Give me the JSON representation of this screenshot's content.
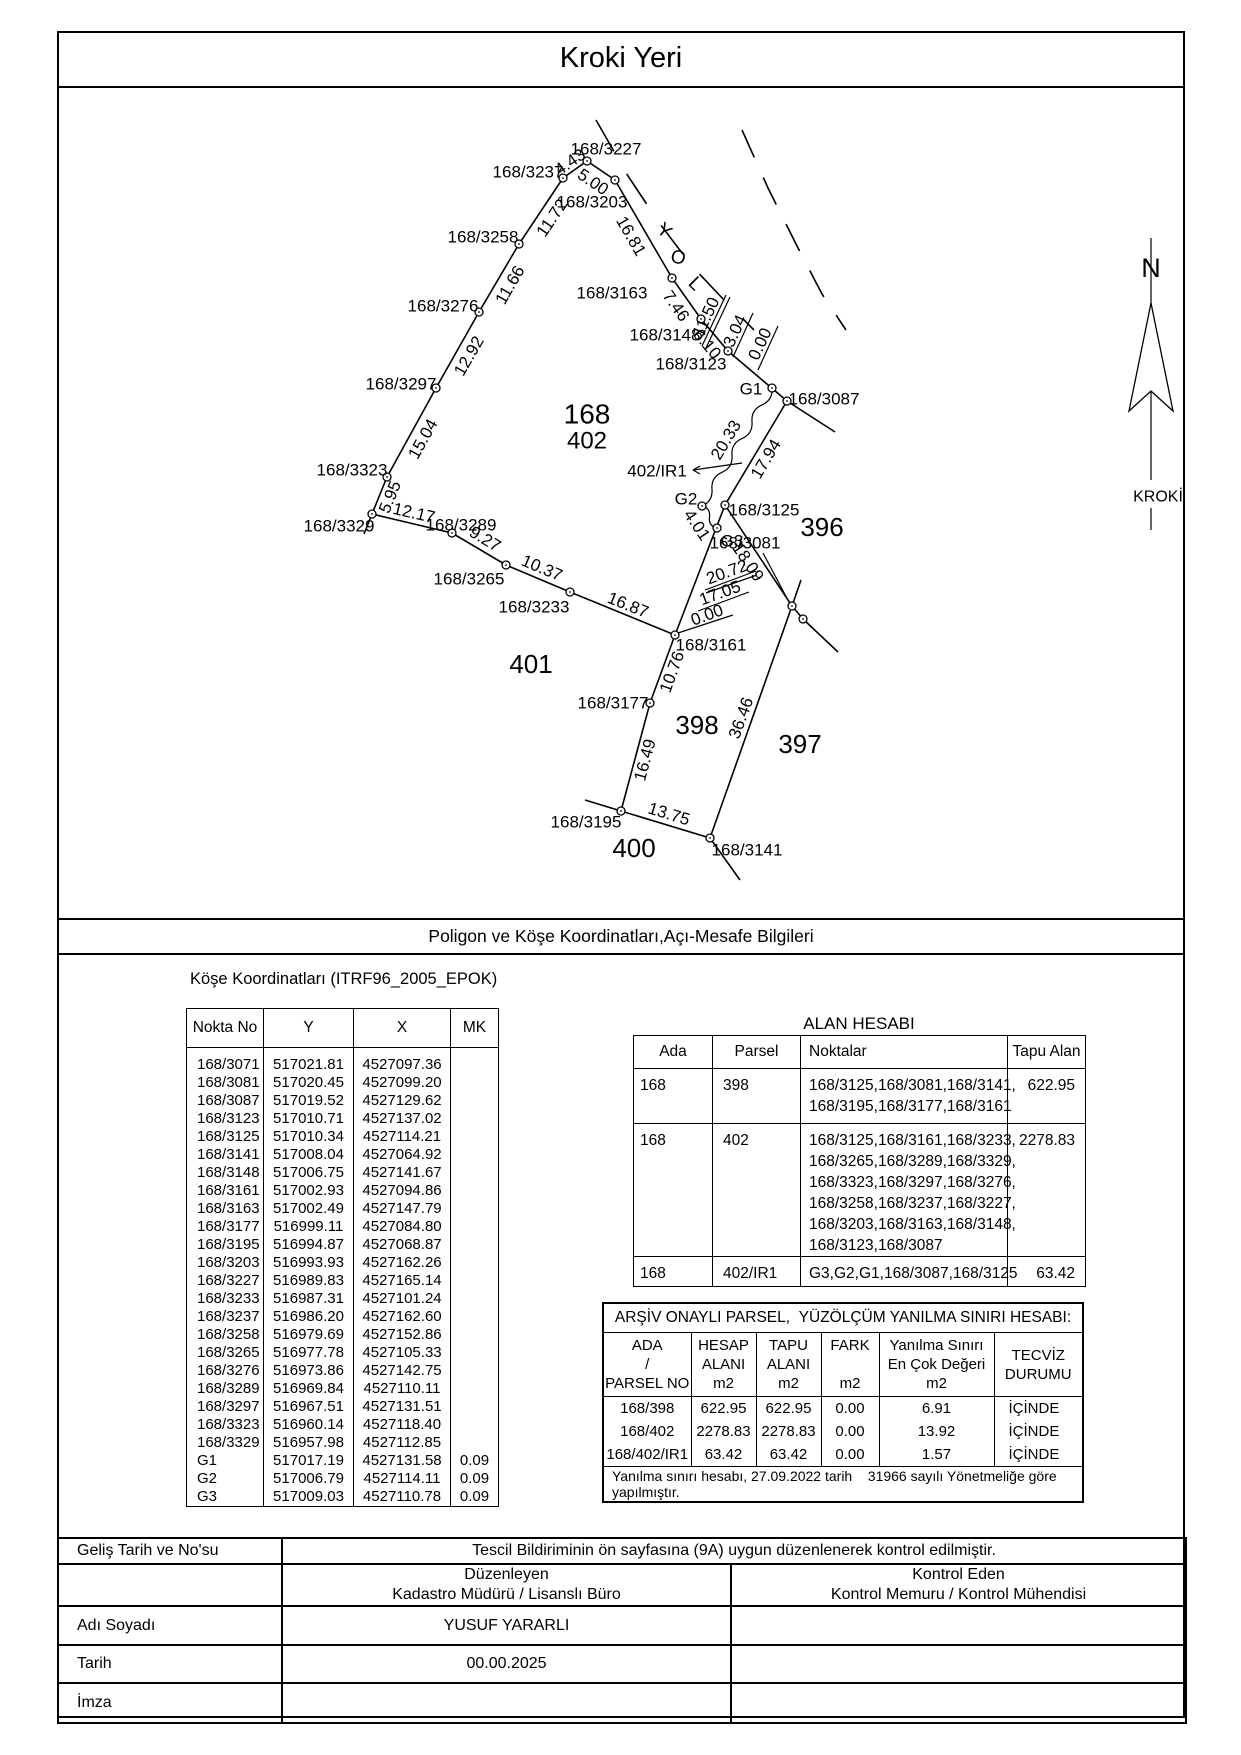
{
  "page": {
    "title": "Kroki Yeri",
    "section_bar": "Poligon ve Köşe Koordinatları,Açı-Mesafe Bilgileri"
  },
  "map": {
    "north": {
      "n": "N",
      "kroki": "KROKİ"
    },
    "yol": {
      "letters": [
        {
          "t": "Y",
          "x": 664,
          "y": 231,
          "r": 40
        },
        {
          "t": "O",
          "x": 678,
          "y": 258,
          "r": 15
        },
        {
          "t": "L",
          "x": 695,
          "y": 284,
          "r": 45
        }
      ]
    },
    "points": {
      "3227": [
        587,
        161
      ],
      "3237": [
        563,
        178
      ],
      "3203": [
        615,
        180
      ],
      "3258": [
        519,
        244
      ],
      "3163": [
        672,
        278
      ],
      "3276": [
        479,
        312
      ],
      "3148": [
        701,
        319
      ],
      "3123": [
        728,
        351
      ],
      "3297": [
        436,
        388
      ],
      "G1": [
        772,
        388
      ],
      "3087": [
        787,
        401
      ],
      "3323": [
        387,
        477
      ],
      "3125": [
        725,
        505
      ],
      "G2": [
        702,
        506
      ],
      "3329": [
        372,
        514
      ],
      "G3": [
        717,
        528
      ],
      "3289": [
        452,
        533
      ],
      "3265": [
        506,
        565
      ],
      "3233": [
        570,
        592
      ],
      "3081": [
        792,
        606
      ],
      "3071": [
        803,
        619
      ],
      "3161": [
        675,
        635
      ],
      "3177": [
        650,
        703
      ],
      "3195": [
        621,
        811
      ],
      "3141": [
        710,
        838
      ]
    },
    "chains": [
      [
        "3329",
        "3323",
        "3297",
        "3276",
        "3258",
        "3237",
        "3227",
        "3203",
        "3163",
        "3148",
        "3123",
        "3087"
      ],
      [
        "3087",
        "3125",
        "3161"
      ],
      [
        "3161",
        "3233",
        "3265",
        "3289",
        "3329"
      ],
      [
        "3161",
        "3177",
        "3195",
        "3141",
        "3081",
        "3125"
      ],
      [
        "3081",
        "3071"
      ]
    ],
    "extensions": [
      [
        372,
        514,
        364,
        534
      ],
      [
        621,
        811,
        585,
        800
      ],
      [
        710,
        838,
        740,
        880
      ],
      [
        787,
        401,
        835,
        432
      ],
      [
        792,
        606,
        801,
        580
      ],
      [
        803,
        619,
        838,
        652
      ]
    ],
    "squiggle": "M772,388 Q773,400 762,404.9 Q751,409.7 752,421.7 Q753,433.7 742,438.6 Q731,443.4 732,455.4 Q733,467.4 722,472.3 Q711,477.1 712,489.1 Q713,501.1 702,506 Q710.7,508.1 709.5,517 Q708.3,525.9 717,528",
    "road_dashes": [
      {
        "pts": "596,120 628,176 660,224 692,266 724,300 754,330",
        "dash": "36 26"
      },
      {
        "pts": "742,130 768,188 796,244 822,294 846,330",
        "dash": "30 22"
      }
    ],
    "callout_lines": [
      [
        702,
        346,
        726,
        295
      ],
      [
        706,
        348,
        730,
        297
      ],
      [
        733,
        357,
        753,
        313
      ],
      [
        758,
        370,
        778,
        326
      ],
      [
        705,
        590,
        756,
        571
      ],
      [
        706,
        593,
        757,
        575
      ],
      [
        698,
        611,
        749,
        592
      ],
      [
        678,
        633,
        733,
        615
      ]
    ],
    "leaders": [
      [
        763,
        553,
        789,
        602
      ],
      [
        693,
        470,
        742,
        463
      ],
      [
        700,
        466,
        693,
        470
      ],
      [
        700,
        474,
        693,
        470
      ]
    ],
    "point_labels": [
      {
        "t": "168/3227",
        "x": 606,
        "y": 149
      },
      {
        "t": "168/3237",
        "x": 528,
        "y": 172
      },
      {
        "t": "168/3203",
        "x": 592,
        "y": 202
      },
      {
        "t": "168/3258",
        "x": 483,
        "y": 237
      },
      {
        "t": "168/3163",
        "x": 612,
        "y": 293
      },
      {
        "t": "168/3276",
        "x": 443,
        "y": 306
      },
      {
        "t": "168/3148",
        "x": 665,
        "y": 335
      },
      {
        "t": "168/3123",
        "x": 691,
        "y": 364
      },
      {
        "t": "168/3297",
        "x": 401,
        "y": 384
      },
      {
        "t": "G1",
        "x": 751,
        "y": 389
      },
      {
        "t": "168/3087",
        "x": 824,
        "y": 399
      },
      {
        "t": "168/3323",
        "x": 352,
        "y": 470
      },
      {
        "t": "402/IR1",
        "x": 657,
        "y": 471
      },
      {
        "t": "G2",
        "x": 686,
        "y": 499
      },
      {
        "t": "168/3125",
        "x": 764,
        "y": 510
      },
      {
        "t": "168/3329",
        "x": 339,
        "y": 526
      },
      {
        "t": "168/3289",
        "x": 461,
        "y": 525
      },
      {
        "t": "G3",
        "x": 732,
        "y": 541
      },
      {
        "t": "168/3081",
        "x": 745,
        "y": 543
      },
      {
        "t": "168/3265",
        "x": 469,
        "y": 579
      },
      {
        "t": "168/3233",
        "x": 534,
        "y": 607
      },
      {
        "t": "168/3161",
        "x": 711,
        "y": 645
      },
      {
        "t": "168/3177",
        "x": 613,
        "y": 703
      },
      {
        "t": "168/3195",
        "x": 586,
        "y": 822
      },
      {
        "t": "168/3141",
        "x": 747,
        "y": 850
      }
    ],
    "dist_labels": [
      {
        "t": "4.43",
        "x": 570,
        "y": 162,
        "r": -35
      },
      {
        "t": "5.00",
        "x": 593,
        "y": 182,
        "r": 34
      },
      {
        "t": "11.72",
        "x": 552,
        "y": 218,
        "r": -56
      },
      {
        "t": "16.81",
        "x": 631,
        "y": 236,
        "r": 60
      },
      {
        "t": "11.66",
        "x": 510,
        "y": 285,
        "r": -60
      },
      {
        "t": "7.46",
        "x": 676,
        "y": 306,
        "r": 55
      },
      {
        "t": "6.10",
        "x": 707,
        "y": 344,
        "r": 50
      },
      {
        "t": "11.50",
        "x": 706,
        "y": 317,
        "r": -65
      },
      {
        "t": "3.04",
        "x": 735,
        "y": 331,
        "r": -65
      },
      {
        "t": "0.00",
        "x": 760,
        "y": 344,
        "r": -65
      },
      {
        "t": "12.92",
        "x": 469,
        "y": 356,
        "r": -60
      },
      {
        "t": "20.33",
        "x": 726,
        "y": 440,
        "r": -59
      },
      {
        "t": "15.04",
        "x": 423,
        "y": 439,
        "r": -61
      },
      {
        "t": "17.94",
        "x": 766,
        "y": 459,
        "r": -59
      },
      {
        "t": "5.95",
        "x": 390,
        "y": 497,
        "r": -68
      },
      {
        "t": "12.17",
        "x": 414,
        "y": 513,
        "r": 13
      },
      {
        "t": "4.01",
        "x": 697,
        "y": 525,
        "r": 56
      },
      {
        "t": "9.27",
        "x": 485,
        "y": 539,
        "r": 31
      },
      {
        "t": "18.09",
        "x": 748,
        "y": 562,
        "r": 56
      },
      {
        "t": "10.37",
        "x": 542,
        "y": 568,
        "r": 23
      },
      {
        "t": "20.72",
        "x": 727,
        "y": 572,
        "r": -20
      },
      {
        "t": "17.05",
        "x": 720,
        "y": 593,
        "r": -20
      },
      {
        "t": "0.00",
        "x": 707,
        "y": 615,
        "r": -20
      },
      {
        "t": "16.87",
        "x": 628,
        "y": 605,
        "r": 22
      },
      {
        "t": "10.76",
        "x": 672,
        "y": 672,
        "r": -70
      },
      {
        "t": "36.46",
        "x": 741,
        "y": 718,
        "r": -70
      },
      {
        "t": "16.49",
        "x": 645,
        "y": 760,
        "r": -75
      },
      {
        "t": "13.75",
        "x": 669,
        "y": 814,
        "r": 17
      }
    ],
    "parcel_labels": [
      {
        "t": "168",
        "x": 587,
        "y": 414,
        "s": 28
      },
      {
        "t": "402",
        "x": 587,
        "y": 441,
        "s": 24
      },
      {
        "t": "396",
        "x": 822,
        "y": 527,
        "s": 26
      },
      {
        "t": "401",
        "x": 531,
        "y": 664,
        "s": 26
      },
      {
        "t": "398",
        "x": 697,
        "y": 725,
        "s": 26
      },
      {
        "t": "397",
        "x": 800,
        "y": 744,
        "s": 26
      },
      {
        "t": "400",
        "x": 634,
        "y": 848,
        "s": 26
      }
    ]
  },
  "coord_table": {
    "caption": "Köşe Koordinatları (ITRF96_2005_EPOK)",
    "headers": [
      "Nokta No",
      "Y",
      "X",
      "MK"
    ],
    "rows": [
      [
        "168/3071",
        "517021.81",
        "4527097.36",
        ""
      ],
      [
        "168/3081",
        "517020.45",
        "4527099.20",
        ""
      ],
      [
        "168/3087",
        "517019.52",
        "4527129.62",
        ""
      ],
      [
        "168/3123",
        "517010.71",
        "4527137.02",
        ""
      ],
      [
        "168/3125",
        "517010.34",
        "4527114.21",
        ""
      ],
      [
        "168/3141",
        "517008.04",
        "4527064.92",
        ""
      ],
      [
        "168/3148",
        "517006.75",
        "4527141.67",
        ""
      ],
      [
        "168/3161",
        "517002.93",
        "4527094.86",
        ""
      ],
      [
        "168/3163",
        "517002.49",
        "4527147.79",
        ""
      ],
      [
        "168/3177",
        "516999.11",
        "4527084.80",
        ""
      ],
      [
        "168/3195",
        "516994.87",
        "4527068.87",
        ""
      ],
      [
        "168/3203",
        "516993.93",
        "4527162.26",
        ""
      ],
      [
        "168/3227",
        "516989.83",
        "4527165.14",
        ""
      ],
      [
        "168/3233",
        "516987.31",
        "4527101.24",
        ""
      ],
      [
        "168/3237",
        "516986.20",
        "4527162.60",
        ""
      ],
      [
        "168/3258",
        "516979.69",
        "4527152.86",
        ""
      ],
      [
        "168/3265",
        "516977.78",
        "4527105.33",
        ""
      ],
      [
        "168/3276",
        "516973.86",
        "4527142.75",
        ""
      ],
      [
        "168/3289",
        "516969.84",
        "4527110.11",
        ""
      ],
      [
        "168/3297",
        "516967.51",
        "4527131.51",
        ""
      ],
      [
        "168/3323",
        "516960.14",
        "4527118.40",
        ""
      ],
      [
        "168/3329",
        "516957.98",
        "4527112.85",
        ""
      ],
      [
        "G1",
        "517017.19",
        "4527131.58",
        "0.09"
      ],
      [
        "G2",
        "517006.79",
        "4527114.11",
        "0.09"
      ],
      [
        "G3",
        "517009.03",
        "4527110.78",
        "0.09"
      ]
    ]
  },
  "alan_hesabi": {
    "title": "ALAN HESABI",
    "headers": [
      "Ada",
      "Parsel",
      "Noktalar",
      "Tapu Alan"
    ],
    "rows": [
      {
        "ada": "168",
        "parsel": "398",
        "noktalar": [
          "168/3125,168/3081,168/3141,",
          "168/3195,168/3177,168/3161"
        ],
        "tapu": "622.95",
        "h": 55
      },
      {
        "ada": "168",
        "parsel": "402",
        "noktalar": [
          "168/3125,168/3161,168/3233,",
          "168/3265,168/3289,168/3329,",
          "168/3323,168/3297,168/3276,",
          "168/3258,168/3237,168/3227,",
          "168/3203,168/3163,168/3148,",
          "168/3123,168/3087"
        ],
        "tapu": "2278.83",
        "h": 125
      },
      {
        "ada": "168",
        "parsel": "402/IR1",
        "noktalar": [
          "G3,G2,G1,168/3087,168/3125"
        ],
        "tapu": "63.42",
        "h": 30
      }
    ]
  },
  "arsiv": {
    "title": "ARŞİV ONAYLI PARSEL,  YÜZÖLÇÜM YANILMA SINIRI HESABI:",
    "headers": [
      [
        "ADA",
        "/",
        "PARSEL NO"
      ],
      [
        "HESAP",
        "ALANI",
        "m2"
      ],
      [
        "TAPU",
        "ALANI",
        "m2"
      ],
      [
        "FARK",
        "",
        "m2"
      ],
      [
        "Yanılma Sınırı",
        "En Çok Değeri",
        "m2"
      ],
      [
        "TECVİZ",
        "DURUMU"
      ]
    ],
    "rows": [
      [
        "168/398",
        "622.95",
        "622.95",
        "0.00",
        "6.91",
        "İÇİNDE"
      ],
      [
        "168/402",
        "2278.83",
        "2278.83",
        "0.00",
        "13.92",
        "İÇİNDE"
      ],
      [
        "168/402/IR1",
        "63.42",
        "63.42",
        "0.00",
        "1.57",
        "İÇİNDE"
      ]
    ],
    "footnote": "Yanılma sınırı hesabı, 27.09.2022 tarih    31966 sayılı Yönetmeliğe göre yapılmıştır."
  },
  "signature": {
    "gelis_label": "Geliş Tarih ve No'su",
    "gelis_value": "Tescil Bildiriminin ön sayfasına (9A) uygun düzenlenerek kontrol edilmiştir.",
    "duzenleyen_1": "Düzenleyen",
    "duzenleyen_2": "Kadastro Müdürü / Lisanslı Büro",
    "kontrol_1": "Kontrol Eden",
    "kontrol_2": "Kontrol Memuru / Kontrol Mühendisi",
    "adi_label": "Adı Soyadı",
    "adi_value": "YUSUF YARARLI",
    "tarih_label": "Tarih",
    "tarih_value": "00.00.2025",
    "imza_label": "İmza",
    "imza_value": ""
  }
}
